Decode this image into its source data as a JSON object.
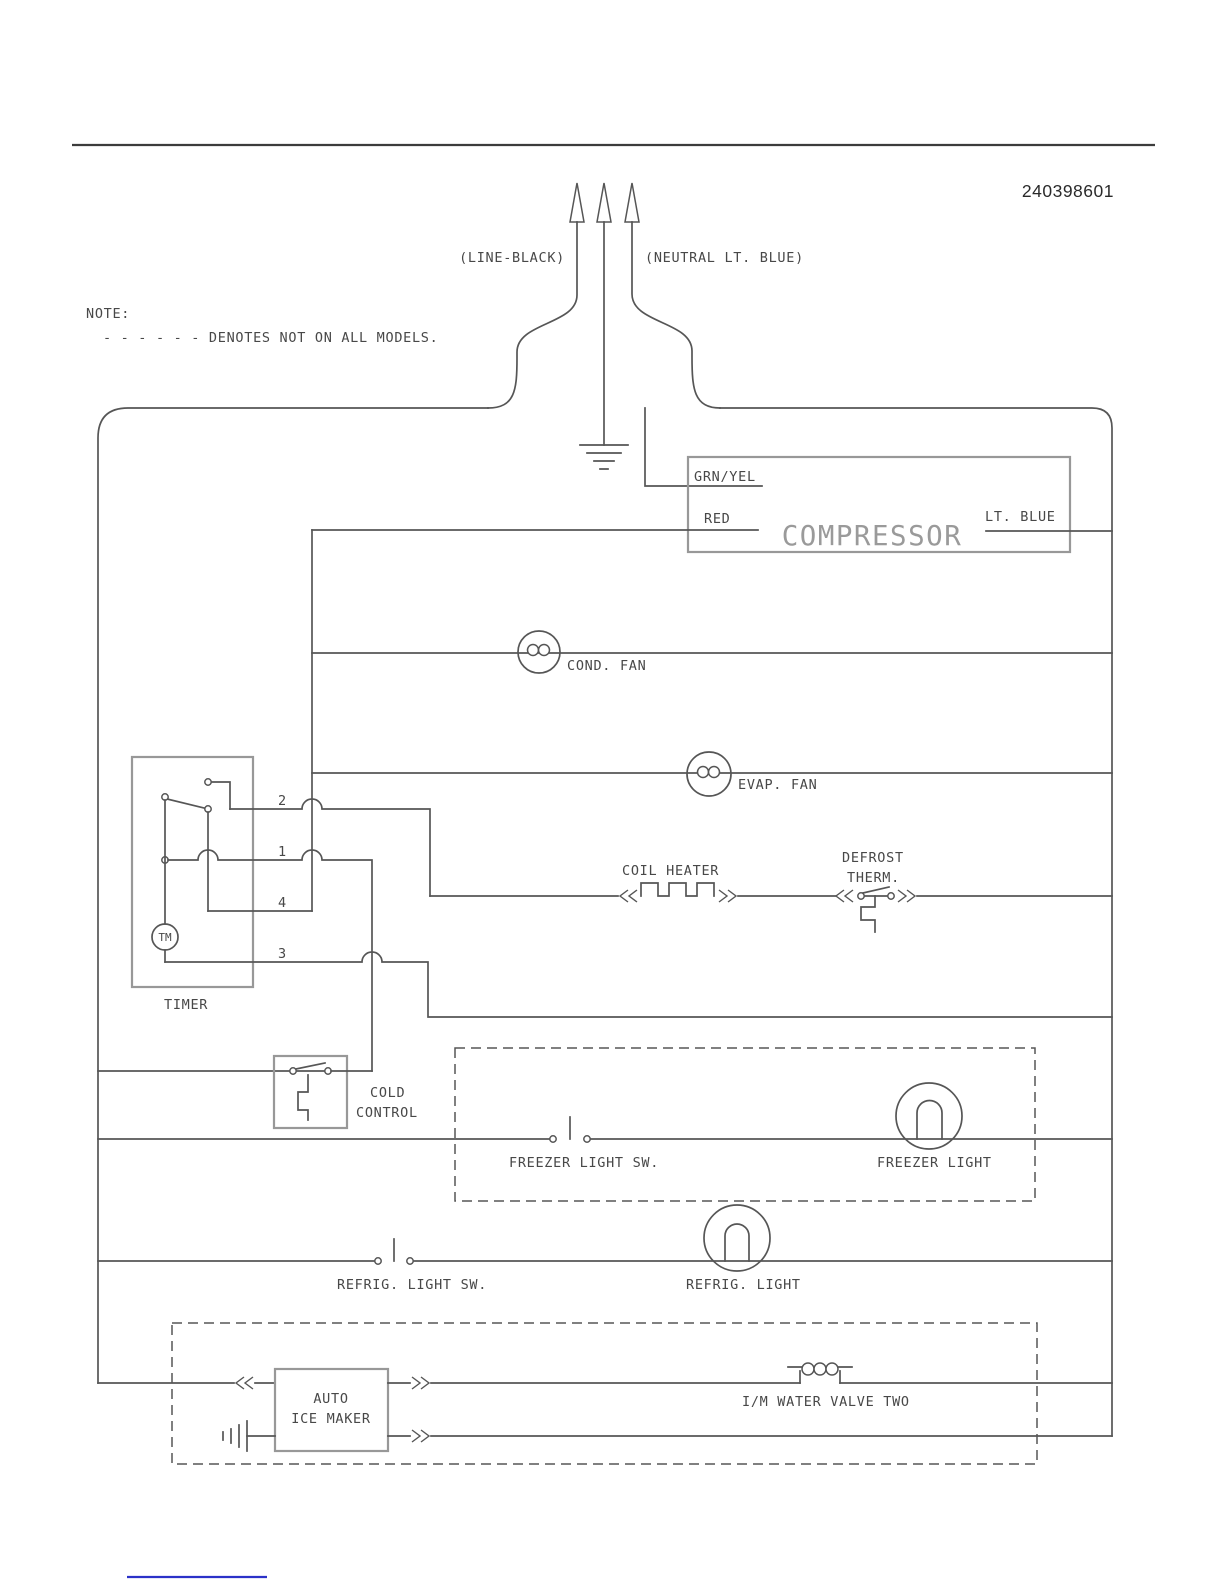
{
  "page": {
    "part_number": "240398601",
    "note_title": "NOTE:",
    "note_body": "- - - - - - DENOTES NOT ON ALL MODELS.",
    "line_label": "(LINE-BLACK)",
    "neutral_label": "(NEUTRAL LT. BLUE)"
  },
  "labels": {
    "compressor": "COMPRESSOR",
    "grn_yel": "GRN/YEL",
    "red": "RED",
    "lt_blue": "LT. BLUE",
    "cond_fan": "COND. FAN",
    "evap_fan": "EVAP. FAN",
    "timer": "TIMER",
    "tm": "TM",
    "t1": "1",
    "t2": "2",
    "t3": "3",
    "t4": "4",
    "coil_heater": "COIL HEATER",
    "defrost_line1": "DEFROST",
    "defrost_line2": "THERM.",
    "cold_line1": "COLD",
    "cold_line2": "CONTROL",
    "freezer_light_sw": "FREEZER LIGHT SW.",
    "freezer_light": "FREEZER LIGHT",
    "refrig_light_sw": "REFRIG. LIGHT SW.",
    "refrig_light": "REFRIG. LIGHT",
    "ice_maker_line1": "AUTO",
    "ice_maker_line2": "ICE MAKER",
    "water_valve": "I/M WATER VALVE TWO"
  },
  "colors": {
    "wire": "#565656",
    "box": "#989898",
    "text": "#484848",
    "compressor_ghost": "#9a9a9a",
    "link": "#2b32c8"
  }
}
